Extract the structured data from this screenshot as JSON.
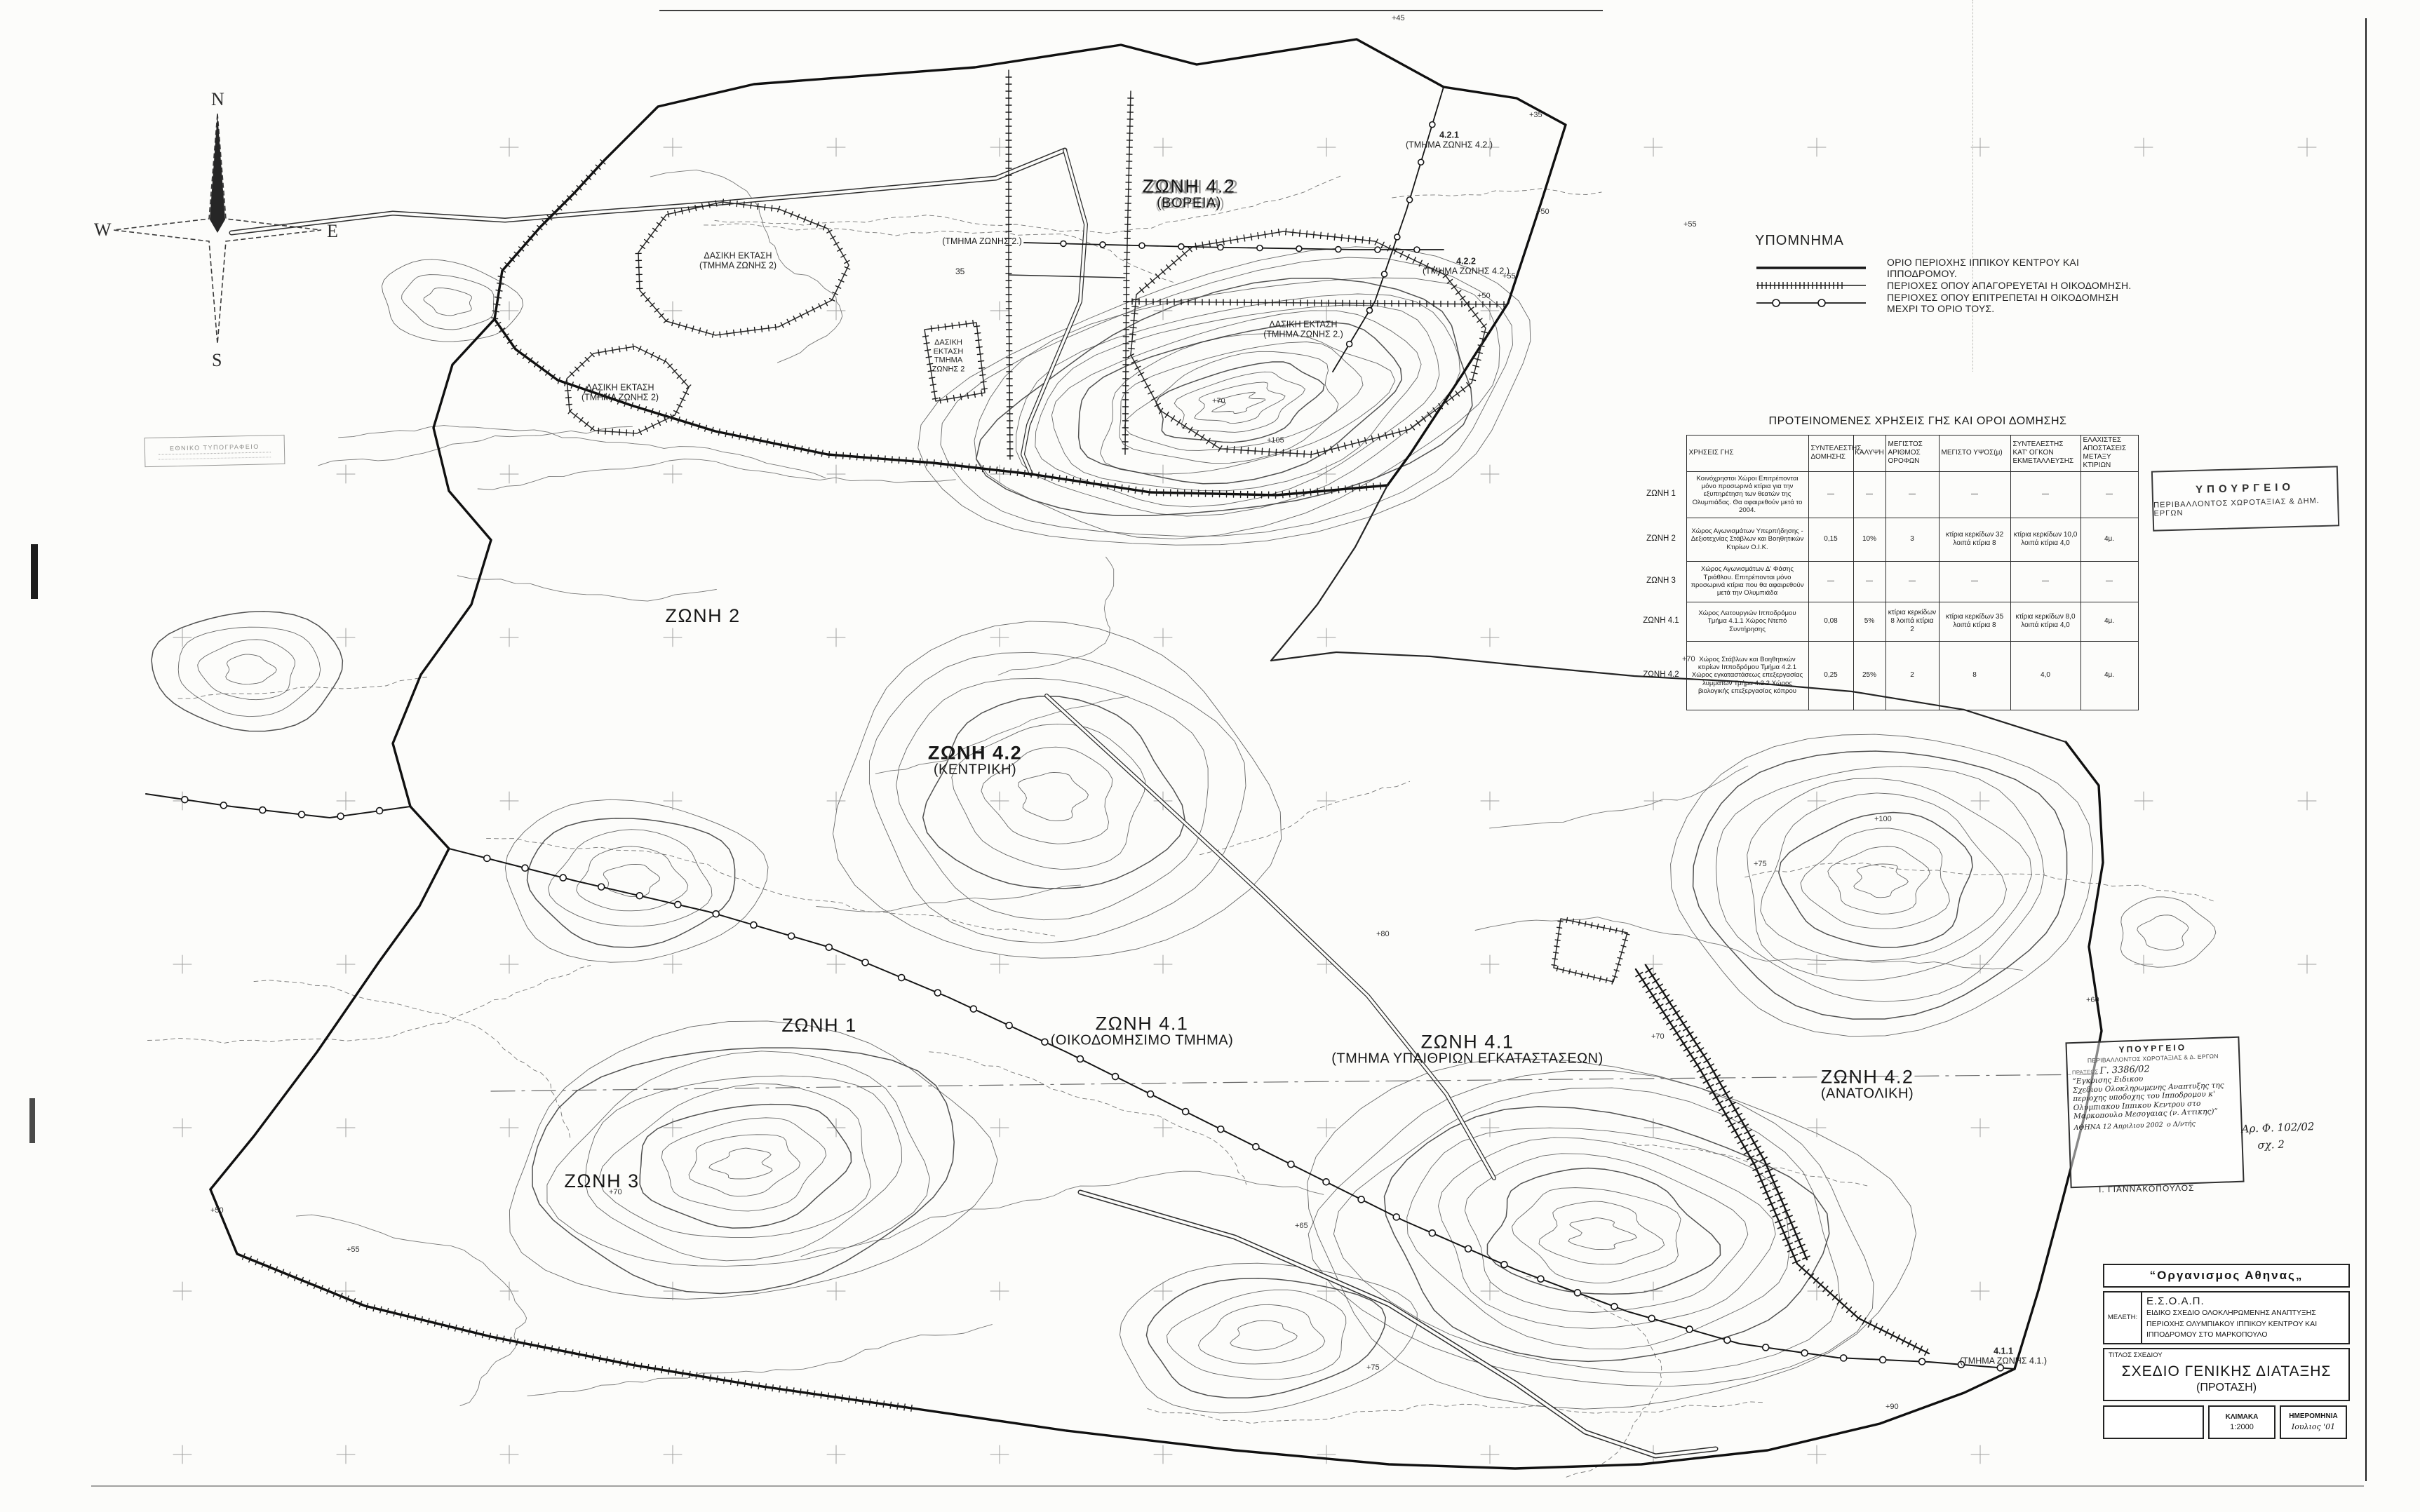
{
  "compass": {
    "n": "N",
    "e": "E",
    "s": "S",
    "w": "W"
  },
  "legend": {
    "title": "ΥΠΟΜΝΗΜΑ",
    "items": [
      {
        "symbol": "solid-line",
        "label": "ΟΡΙΟ ΠΕΡΙΟΧΗΣ ΙΠΠΙΚΟΥ ΚΕΝΤΡΟΥ ΚΑΙ ΙΠΠΟΔΡΟΜΟΥ."
      },
      {
        "symbol": "hatched-line",
        "label": "ΠΕΡΙΟΧΕΣ ΟΠΟΥ ΑΠΑΓΟΡΕΥΕΤΑΙ Η ΟΙΚΟΔΟΜΗΣΗ."
      },
      {
        "symbol": "circle-line",
        "label": "ΠΕΡΙΟΧΕΣ ΟΠΟΥ ΕΠΙΤΡΕΠΕΤΑΙ Η ΟΙΚΟΔΟΜΗΣΗ ΜΕΧΡΙ ΤΟ ΟΡΙΟ ΤΟΥΣ."
      }
    ]
  },
  "table": {
    "title": "ΠΡΟΤΕΙΝΟΜΕΝΕΣ ΧΡΗΣΕΙΣ ΓΗΣ ΚΑΙ ΟΡΟΙ ΔΟΜΗΣΗΣ",
    "columns": [
      "ΧΡΗΣΕΙΣ ΓΗΣ",
      "ΣΥΝΤΕΛΕΣΤΗΣ ΔΟΜΗΣΗΣ",
      "ΚΑΛΥΨΗ",
      "ΜΕΓΙΣΤΟΣ ΑΡΙΘΜΟΣ ΟΡΟΦΩΝ",
      "ΜΕΓΙΣΤΟ ΥΨΟΣ(μ)",
      "ΣΥΝΤΕΛΕΣΤΗΣ ΚΑΤ' ΟΓΚΟΝ ΕΚΜΕΤΑΛΛΕΥΣΗΣ",
      "ΕΛΑΧΙΣΤΕΣ ΑΠΟΣΤΑΣΕΙΣ ΜΕΤΑΞΥ ΚΤΙΡΙΩΝ"
    ],
    "rows": [
      [
        "ΖΩΝΗ 1",
        "Κοινόχρηστοι Χώροι Επιτρέπονται μόνο προσωρινά κτίρια για την εξυπηρέτηση των θεατών της Ολυμπιάδας. Θα αφαιρεθούν μετά το 2004.",
        "—",
        "—",
        "—",
        "—",
        "—",
        "—"
      ],
      [
        "ΖΩΝΗ 2",
        "Χώρος Αγωνισμάτων Υπερπήδησης - Δεξιοτεχνίας Στάβλων και Βοηθητικών Κτιρίων Ο.Ι.Κ.",
        "0,15",
        "10%",
        "3",
        "κτίρια κερκίδων 32 λοιπά κτίρια 8",
        "κτίρια κερκίδων 10,0 λοιπά κτίρια 4,0",
        "4μ."
      ],
      [
        "ΖΩΝΗ 3",
        "Χώρος Αγωνισμάτων Δ' Φάσης Τριάθλου. Επιτρέπονται μόνο προσωρινά κτίρια που θα αφαιρεθούν μετά την Ολυμπιάδα",
        "—",
        "—",
        "—",
        "—",
        "—",
        "—"
      ],
      [
        "ΖΩΝΗ 4.1",
        "Χώρος Λειτουργιών Ιπποδρόμου Τμήμα 4.1.1 Χώρος Ντεπό Συντήρησης",
        "0,08",
        "5%",
        "κτίρια κερκίδων 8 λοιπά κτίρια 2",
        "κτίρια κερκίδων 35 λοιπά κτίρια 8",
        "κτίρια κερκίδων 8,0 λοιπά κτίρια 4,0",
        "4μ."
      ],
      [
        "ΖΩΝΗ 4.2",
        "Χώρος Στάβλων και Βοηθητικών κτιρίων Ιπποδρόμου Τμήμα 4.2.1 Χώρος εγκαταστάσεως επεξεργασίας λυμμάτων Τμήμα 4.2.2 Χώρος βιολογικής επεξεργασίας κόπρου",
        "0,25",
        "25%",
        "2",
        "8",
        "4,0",
        "4μ."
      ]
    ]
  },
  "map": {
    "zones": [
      {
        "name": "ΖΩΝΗ 4.2",
        "sub": "(ΒΟΡΕΙΑ)"
      },
      {
        "name": "ΖΩΝΗ 2",
        "sub": ""
      },
      {
        "name": "ΖΩΝΗ 4.2",
        "sub": "(ΚΕΝΤΡΙΚΗ)"
      },
      {
        "name": "ΖΩΝΗ 1",
        "sub": ""
      },
      {
        "name": "ΖΩΝΗ 4.1",
        "sub": "(ΟΙΚΟΔΟΜΗΣΙΜΟ ΤΜΗΜΑ)"
      },
      {
        "name": "ΖΩΝΗ 4.1",
        "sub": "(ΤΜΗΜΑ ΥΠΑΙΘΡΙΩΝ ΕΓΚΑΤΑΣΤΑΣΕΩΝ)"
      },
      {
        "name": "ΖΩΝΗ 4.2",
        "sub": "(ΑΝΑΤΟΛΙΚΗ)"
      },
      {
        "name": "ΖΩΝΗ 3",
        "sub": ""
      }
    ],
    "area_labels": [
      {
        "l1": "(ΤΜΗΜΑ ΖΩΝΗΣ 2.)",
        "l2": ""
      },
      {
        "l1": "ΔΑΣΙΚΗ ΕΚΤΑΣΗ",
        "l2": "(ΤΜΗΜΑ ΖΩΝΗΣ 2)"
      },
      {
        "l1": "ΔΑΣΙΚΗ ΕΚΤΑΣΗ",
        "l2": "(ΤΜΗΜΑ ΖΩΝΗΣ 2)"
      },
      {
        "l1": "ΔΑΣΙΚΗ ΕΚΤΑΣΗ",
        "l2": "ΤΜΗΜΑ ΖΩΝΗΣ 2"
      },
      {
        "l1": "ΔΑΣΙΚΗ ΕΚΤΑΣΗ",
        "l2": "(ΤΜΗΜΑ ΖΩΝΗΣ 2.)"
      },
      {
        "l1": "4.2.1",
        "l2": "(ΤΜΗΜΑ ΖΩΝΗΣ 4.2.)"
      },
      {
        "l1": "4.2.2",
        "l2": "(ΤΜΗΜΑ ΖΩΝΗΣ 4.2.)"
      },
      {
        "l1": "4.1.1",
        "l2": "(ΤΜΗΜΑ ΖΩΝΗΣ 4.1.)"
      }
    ],
    "point_note": "35",
    "elevations": [
      "+45",
      "+35",
      "+50",
      "+55",
      "+55",
      "+50",
      "+70",
      "+105",
      "+70",
      "+100",
      "+75",
      "+80",
      "+70",
      "+70",
      "+55",
      "+50",
      "+65",
      "+75",
      "+90",
      "+60"
    ]
  },
  "stamps": {
    "ministry": {
      "line1": "ΥΠΟΥΡΓΕΙΟ",
      "line2": "ΠΕΡΙΒΑΛΛΟΝΤΟΣ ΧΩΡΟΤΑΞΙΑΣ & ΔΗΜ. ΕΡΓΩΝ"
    },
    "approval": {
      "line1": "ΥΠΟΥΡΓΕΙΟ",
      "line2": "ΠΕΡΙΒΑΛΛΟΝΤΟΣ ΧΩΡΟΤΑΞΙΑΣ & Δ. ΕΡΓΩΝ",
      "protocol_prefix": "ΠΡΑΞΕΩΣ",
      "protocol": "Γ. 3386/02",
      "hand1": "“Εγκρισης Ειδικου",
      "hand2": "Σχεδιου Ολοκληρωμενης Αναπτυξης της",
      "hand3": "περιοχης υποδοχης του Ιπποδρομου κ'",
      "hand4": "Ολυμπιακου Ιππικου Κεντρου στο",
      "hand5": "Μαρκοπουλο Μεσογαιας (ν. Αττικης)”",
      "city_date": "ΑΘΗΝΑ 12 Απριλιου 2002",
      "role": "ο Δ/ντής",
      "signature": "Ι. ΓΙΑΝΝΑΚΟΠΟΥΛΟΣ",
      "ref1": "Αρ. Φ. 102/02",
      "ref2": "σχ. 2"
    },
    "printing_office": {
      "line1": "ΕΘΝΙΚΟ ΤΥΠΟΓΡΑΦΕΙΟ"
    }
  },
  "title_block": {
    "org_name": "“Οργανισμος  Αθηνας„",
    "meleti_label": "ΜΕΛΕΤΗ:",
    "project_code": "Ε.Σ.Ο.Α.Π.",
    "project_line1": "ΕΙΔΙΚΟ ΣΧΕΔΙΟ ΟΛΟΚΛΗΡΩΜΕΝΗΣ ΑΝΑΠΤΥΞΗΣ",
    "project_line2": "ΠΕΡΙΟΧΗΣ ΟΛΥΜΠΙΑΚΟΥ ΙΠΠΙΚΟΥ ΚΕΝΤΡΟΥ ΚΑΙ",
    "project_line3": "ΙΠΠΟΔΡΟΜΟΥ ΣΤΟ ΜΑΡΚΟΠΟΥΛΟ",
    "title_label": "ΤΙΤΛΟΣ ΣΧΕΔΙΟΥ",
    "title": "ΣΧΕΔΙΟ ΓΕΝΙΚΗΣ ΔΙΑΤΑΞΗΣ",
    "subtitle": "(ΠΡΟΤΑΣΗ)",
    "scale_label": "ΚΛΙΜΑΚΑ",
    "scale_value": "1:2000",
    "date_label": "ΗΜΕΡΟΜΗΝΙΑ",
    "date_value": "Ιουλιος '01"
  }
}
